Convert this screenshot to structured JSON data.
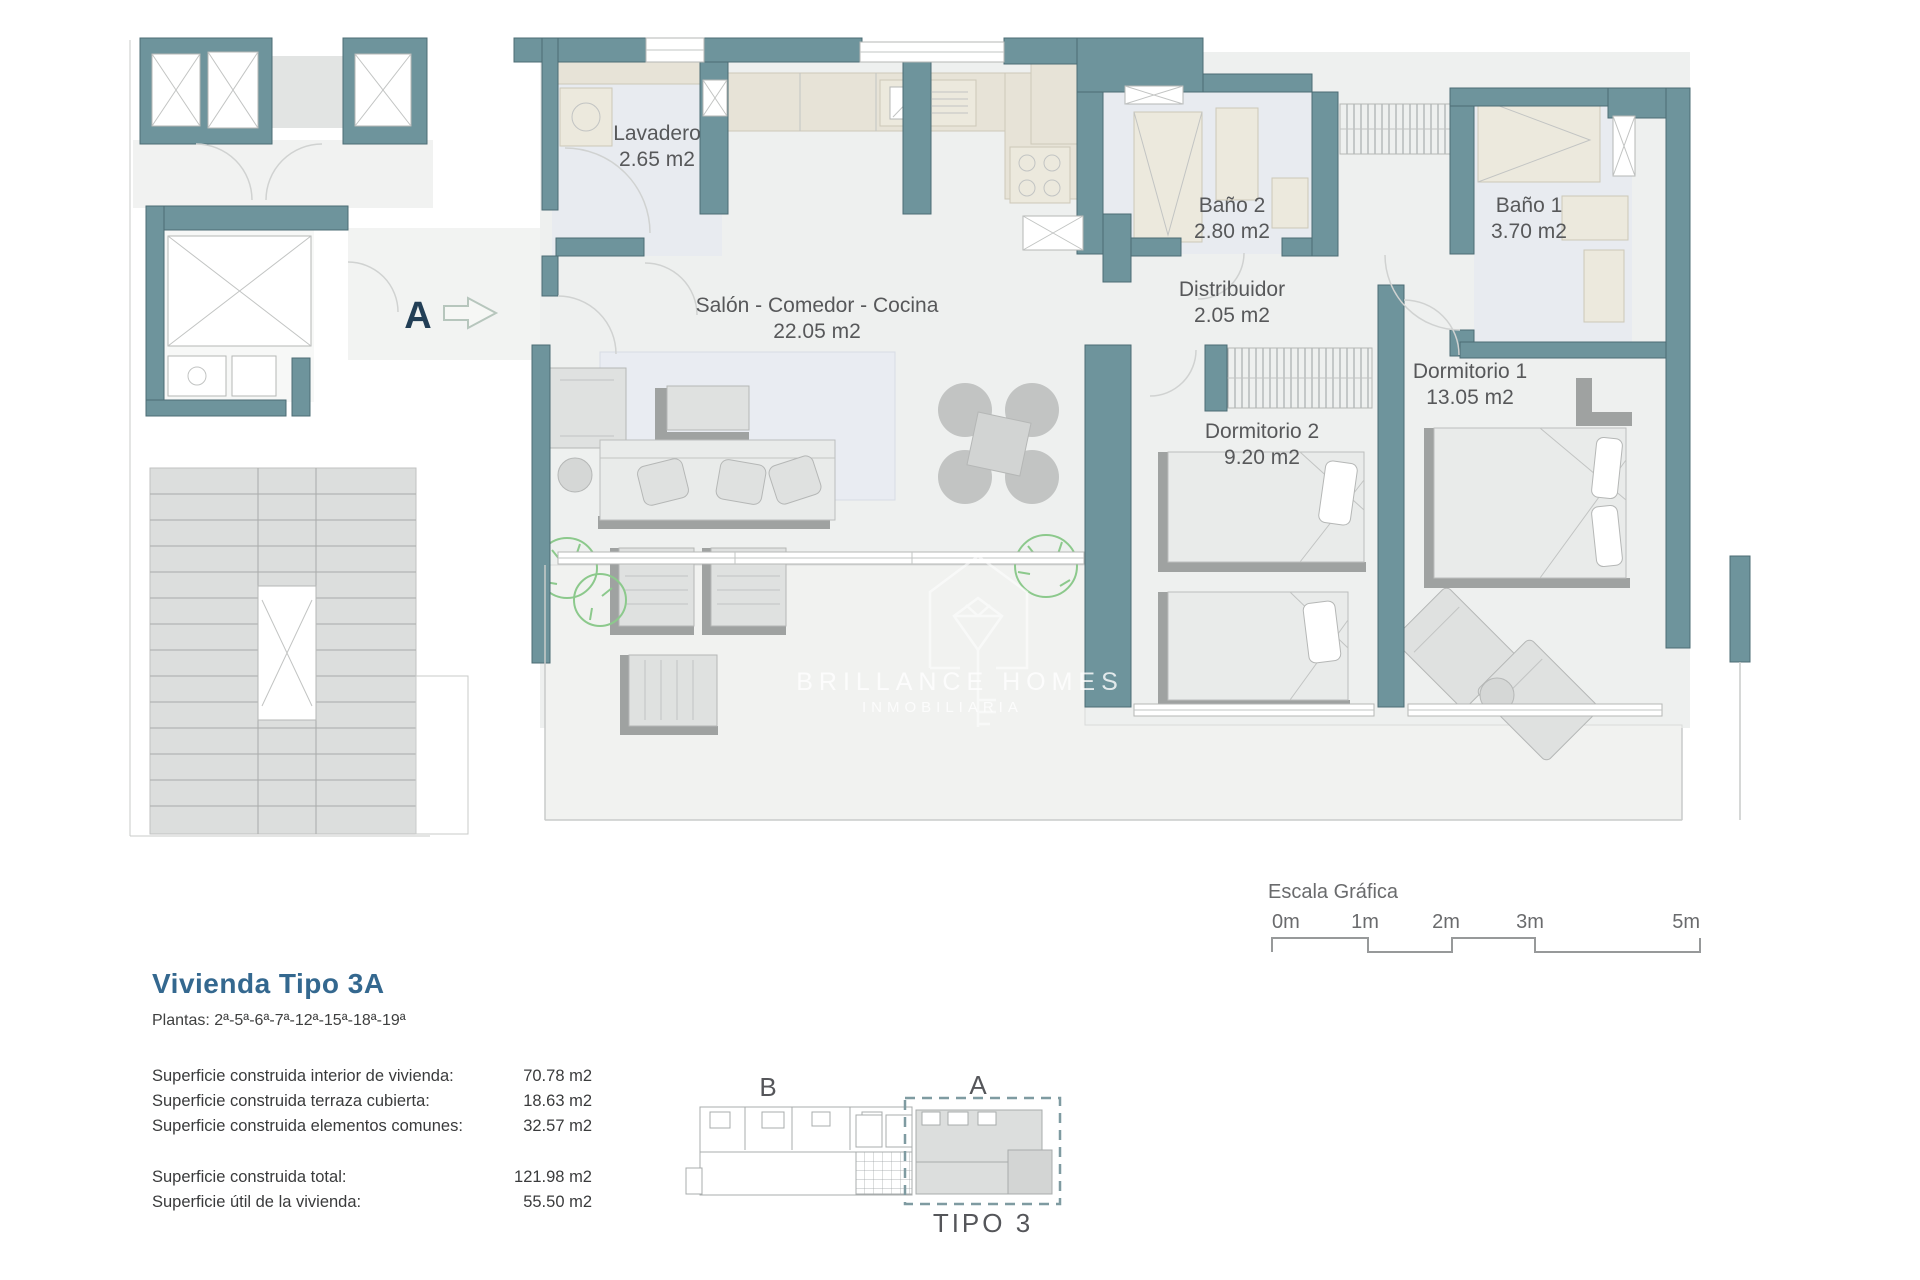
{
  "plan": {
    "entry_label": "A",
    "rooms": [
      {
        "name": "Lavadero",
        "area": "2.65 m2"
      },
      {
        "name": "Salón - Comedor - Cocina",
        "area": "22.05 m2"
      },
      {
        "name": "Baño 2",
        "area": "2.80 m2"
      },
      {
        "name": "Baño 1",
        "area": "3.70 m2"
      },
      {
        "name": "Distribuidor",
        "area": "2.05 m2"
      },
      {
        "name": "Dormitorio 1",
        "area": "13.05 m2"
      },
      {
        "name": "Dormitorio 2",
        "area": "9.20 m2"
      }
    ],
    "watermark": {
      "line1": "BRILLANCE HOMES",
      "line2": "INMOBILIARIA"
    }
  },
  "scale": {
    "title": "Escala Gráfica",
    "ticks": [
      "0m",
      "1m",
      "2m",
      "3m",
      "5m"
    ]
  },
  "info": {
    "title": "Vivienda Tipo 3A",
    "plantas": "Plantas: 2ª-5ª-6ª-7ª-12ª-15ª-18ª-19ª",
    "rows": [
      {
        "label": "Superficie construida interior de vivienda:",
        "value": "70.78 m2"
      },
      {
        "label": "Superficie construida terraza cubierta:",
        "value": "18.63 m2"
      },
      {
        "label": "Superficie construida elementos comunes:",
        "value": "32.57 m2"
      }
    ],
    "totals": [
      {
        "label": "Superficie construida total:",
        "value": "121.98 m2"
      },
      {
        "label": "Superficie útil de la vivienda:",
        "value": "55.50 m2"
      }
    ]
  },
  "keyplan": {
    "label_b": "B",
    "label_a": "A",
    "caption": "TIPO 3"
  },
  "colors": {
    "wall_teal": "#6e949c",
    "floor_gray": "#eef0ef",
    "wet_floor": "#e8ebf0",
    "counter_beige": "#e7e3d7",
    "furniture_gray": "#dfe1e0",
    "plant_green": "#8cc98c",
    "label_text": "#57585a",
    "title_blue": "#34688f",
    "entry_navy": "#223e56"
  }
}
